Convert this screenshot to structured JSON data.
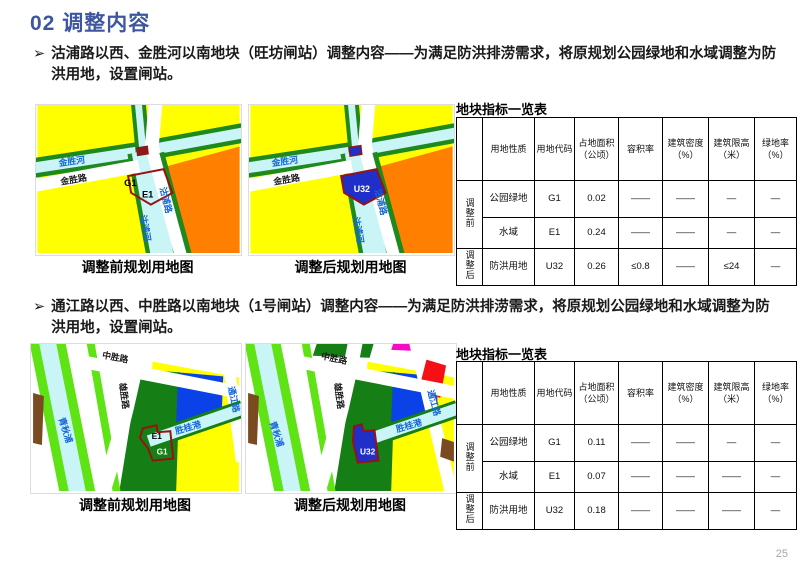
{
  "title": "02 调整内容",
  "bullet_marker": "➢",
  "page_number": "25",
  "colors": {
    "title_blue": "#3E56A0",
    "parcel_outline_red": "#9B1010",
    "parcel_fill_blue": "#1F2FC8",
    "residential_yellow": "#FFFF00",
    "commercial_orange": "#FF8000",
    "green_space": "#1E8A1E",
    "bright_green": "#5FE315",
    "water_cyan": "#C9F5F7",
    "blue_block": "#0A42E8",
    "red_block": "#F51015",
    "magenta_block": "#F70BC4",
    "brown_block": "#7A4A21",
    "river_label_blue": "#1566D6"
  },
  "sections": [
    {
      "bullet": "沽浦路以西、金胜河以南地块（旺坊闸站）调整内容——为满足防洪排涝需求，将原规划公园绿地和水域调整为防洪用地，设置闸站。",
      "table": {
        "title": "地块指标一览表",
        "headers": [
          "",
          "用地性质",
          "用地代码",
          "占地面积（公顷）",
          "容积率",
          "建筑密度（%）",
          "建筑限高（米）",
          "绿地率（%）"
        ],
        "groups": [
          {
            "label": "调整前",
            "rows": [
              [
                "公园绿地",
                "G1",
                "0.02",
                "——",
                "——",
                "—",
                "—"
              ],
              [
                "水域",
                "E1",
                "0.24",
                "——",
                "——",
                "—",
                "—"
              ]
            ]
          },
          {
            "label": "调整后",
            "rows": [
              [
                "防洪用地",
                "U32",
                "0.26",
                "≤0.8",
                "——",
                "≤24",
                "—"
              ]
            ]
          }
        ]
      }
    },
    {
      "bullet": "通江路以西、中胜路以南地块（1号闸站）调整内容——为满足防洪排涝需求，将原规划公园绿地和水域调整为防洪用地，设置闸站。",
      "table": {
        "title": "地块指标一览表",
        "headers": [
          "",
          "用地性质",
          "用地代码",
          "占地面积（公顷）",
          "容积率",
          "建筑密度（%）",
          "建筑限高（米）",
          "绿地率（%）"
        ],
        "groups": [
          {
            "label": "调整前",
            "rows": [
              [
                "公园绿地",
                "G1",
                "0.11",
                "——",
                "——",
                "—",
                "—"
              ],
              [
                "水域",
                "E1",
                "0.07",
                "——",
                "——",
                "——",
                "—"
              ]
            ]
          },
          {
            "label": "调整后",
            "rows": [
              [
                "防洪用地",
                "U32",
                "0.18",
                "——",
                "——",
                "——",
                "—"
              ]
            ]
          }
        ]
      }
    }
  ],
  "maps": {
    "m1": {
      "caption": "调整前规划用地图",
      "river_h": "金胜河",
      "road_h": "金胜路",
      "road_v": "沽浦路",
      "river_v": "沽浦河",
      "g1": "G1",
      "e1": "E1"
    },
    "m2": {
      "caption": "调整后规划用地图",
      "river_h": "金胜河",
      "road_h": "金胜路",
      "road_v": "沽浦路",
      "river_v": "沽浦河",
      "u32": "U32"
    },
    "m3": {
      "caption": "调整前规划用地图",
      "road_top": "中胜路",
      "road_left": "雄胜路",
      "waterway": "青秋浦",
      "river_h": "胜桂港",
      "road_right": "通江路",
      "e1": "E1",
      "g1": "G1"
    },
    "m4": {
      "caption": "调整后规划用地图",
      "road_top": "中胜路",
      "road_left": "雄胜路",
      "waterway": "青秋浦",
      "river_h": "胜桂港",
      "road_right": "通江路",
      "u32": "U32"
    }
  }
}
